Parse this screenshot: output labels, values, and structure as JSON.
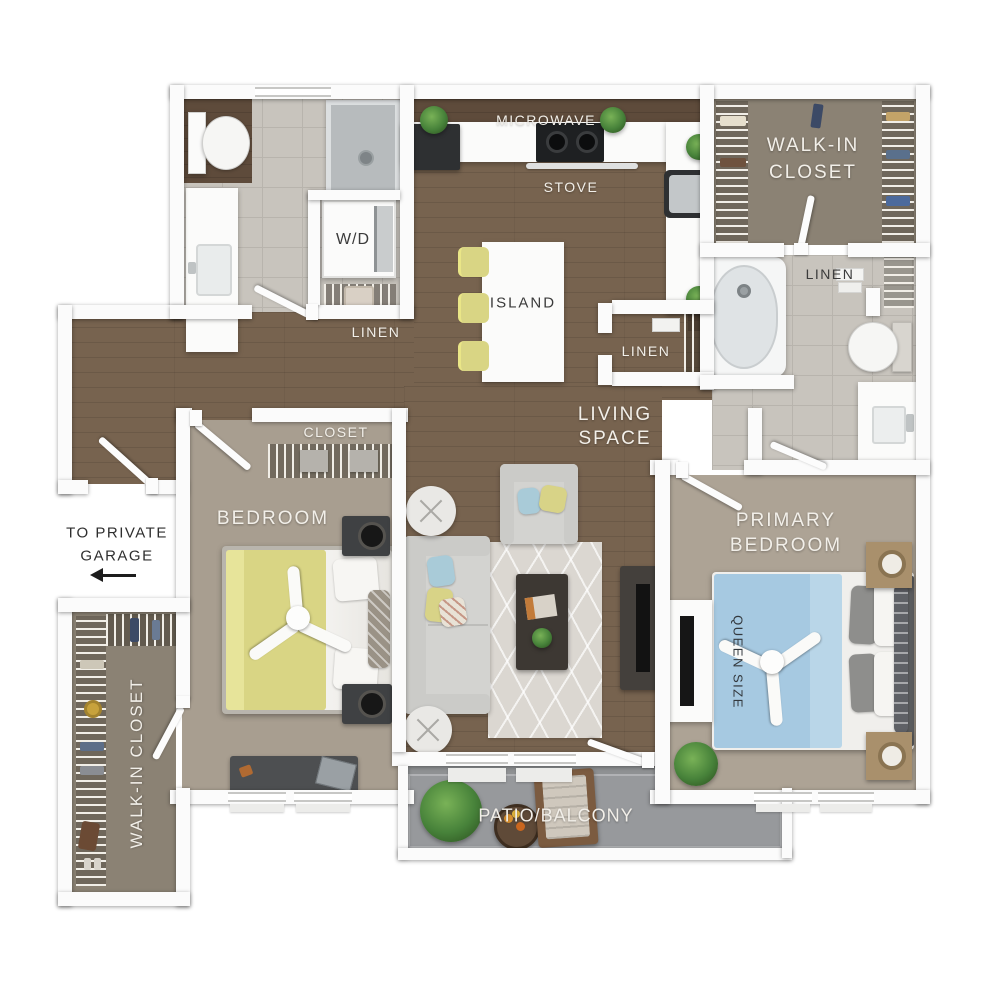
{
  "colors": {
    "wall": "#fbfbfb",
    "wood": "#77634f",
    "wood_dark": "#5e4b3b",
    "tile": "#c8c4bd",
    "grout": "#b8b4ad",
    "carpet_bedroom": "#a89e90",
    "carpet_primary": "#ada395",
    "carpet_closet": "#8b8274",
    "patio_concrete": "#8f9193",
    "rug": "#dbd7d1",
    "sofa": "#d3d3d0",
    "bed_yellow": "#d9d584",
    "bed_blue": "#a6c9e1",
    "furniture_dark": "#3f4143",
    "plant_green": "#47823a",
    "label_light": "#f2efe9",
    "label_dark": "#3b3b3b"
  },
  "labels": {
    "microwave": "MICROWAVE",
    "stove": "STOVE",
    "island": "ISLAND",
    "walk_in_closet_top": {
      "line1": "WALK-IN",
      "line2": "CLOSET"
    },
    "linen_laundry": "LINEN",
    "linen_hall": "LINEN",
    "linen_bath": "LINEN",
    "washer_dryer": "W/D",
    "living_space": {
      "line1": "LIVING",
      "line2": "SPACE"
    },
    "closet": "CLOSET",
    "bedroom": "BEDROOM",
    "primary_bedroom": {
      "line1": "PRIMARY",
      "line2": "BEDROOM"
    },
    "queen_size": "QUEEN SIZE",
    "walk_in_closet_bottom": "WALK-IN CLOSET",
    "patio": "PATIO/BALCONY",
    "garage_note": {
      "line1": "TO PRIVATE",
      "line2": "GARAGE"
    }
  }
}
